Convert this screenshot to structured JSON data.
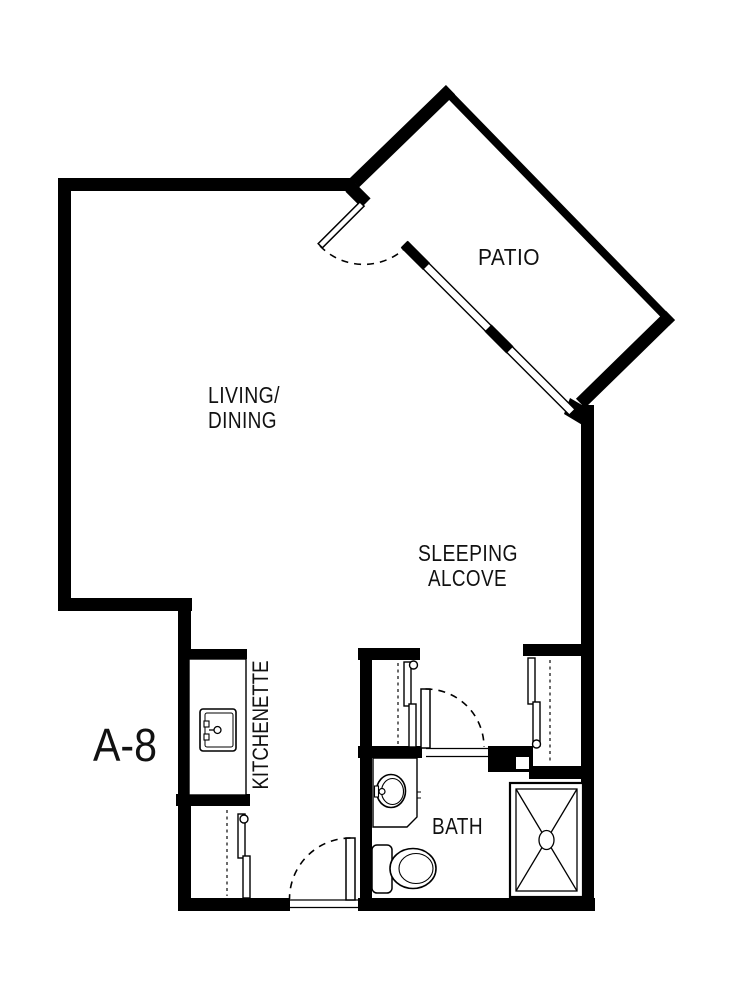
{
  "canvas": {
    "background": "#ffffff",
    "wall_color": "#000000",
    "text_color": "#111111"
  },
  "unit": {
    "label": "A-8"
  },
  "rooms": {
    "living_dining": {
      "line1": "LIVING/",
      "line2": "DINING"
    },
    "patio": {
      "label": "PATIO"
    },
    "sleeping_alcove": {
      "line1": "SLEEPING",
      "line2": "ALCOVE"
    },
    "kitchenette": {
      "label": "KITCHENETTE"
    },
    "bath": {
      "label": "BATH"
    }
  },
  "fixtures": {
    "kitchen_sink": "kitchen-sink-icon",
    "bath_sink": "bathroom-sink-icon",
    "toilet": "toilet-icon",
    "shower": "shower-icon",
    "swing_doors": "door-swing-icon",
    "sliding_doors": "sliding-door-icon",
    "closet_rods": "closet-rod-dashed-line"
  }
}
